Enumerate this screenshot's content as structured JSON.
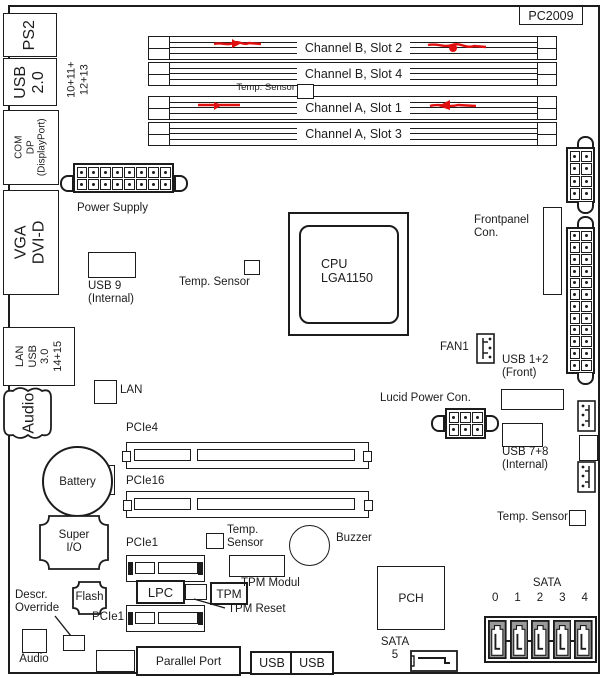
{
  "colors": {
    "line": "#1c1c1c",
    "marker_red": "#e01010",
    "sata_gray": "#9a9a9a"
  },
  "board_id": "PC2009",
  "rear_ports": {
    "ps2": "PS2",
    "usb20": "USB\n2.0",
    "usb20_note": "10+11+\n12+13",
    "com": "COM\nDP\n(DisplayPort)",
    "vga": "VGA\nDVI-D",
    "lan": "LAN\nUSB\n3.0\n14+15",
    "audio": "Audio"
  },
  "memory": {
    "slots": [
      {
        "label": "Channel B, Slot 2",
        "marked": true
      },
      {
        "label": "Channel B, Slot 4",
        "marked": false
      },
      {
        "label": "Channel A, Slot 1",
        "marked": true
      },
      {
        "label": "Channel A, Slot 3",
        "marked": false
      }
    ],
    "temp_sensor": "Temp. Sensor"
  },
  "components": {
    "power_supply": "Power Supply",
    "usb9": "USB 9\n(Internal)",
    "temp_sensor": "Temp. Sensor",
    "temp_sensor_2l": "Temp.\nSensor",
    "cpu": "CPU\nLGA1150",
    "frontpanel": "Frontpanel\nCon.",
    "fan1": "FAN1",
    "usb12": "USB 1+2\n(Front)",
    "lucid": "Lucid Power Con.",
    "usb78": "USB 7+8\n(Internal)",
    "lan": "LAN",
    "pcie4": "PCIe4",
    "pcie16": "PCIe16",
    "pcie1": "PCIe1",
    "battery": "Battery",
    "super_io": "Super\nI/O",
    "flash": "Flash",
    "descr_override": "Descr.\nOverride",
    "audio": "Audio",
    "lpc": "LPC",
    "tpm": "TPM",
    "tpm_reset": "TPM Reset",
    "tpm_modul": "TPM Modul",
    "buzzer": "Buzzer",
    "pch": "PCH",
    "parallel_port": "Parallel Port",
    "usb": "USB",
    "sata_title": "SATA",
    "sata5": "SATA\n5",
    "sata_ports": [
      "0",
      "1",
      "2",
      "3",
      "4"
    ]
  }
}
